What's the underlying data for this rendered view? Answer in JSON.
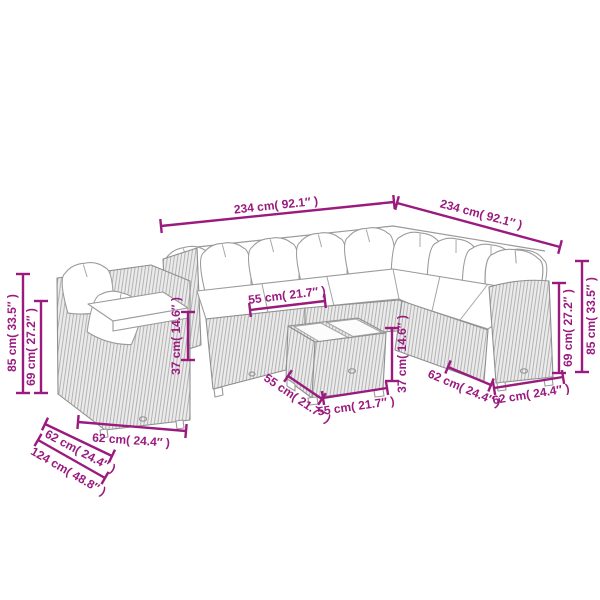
{
  "diagram": {
    "type": "furniture-dimension-diagram",
    "subject": "rattan corner sofa set with coffee table",
    "colors": {
      "dimension_accent": "#9a1a7e",
      "line_art": "#9a9a9a",
      "rattan_fill": "#ebebeb",
      "rattan_hatch": "#b2b2b2",
      "cushion": "#ffffff",
      "background": "#ffffff"
    },
    "dimensions": [
      {
        "id": "sofa-width-left",
        "label": "234 cm( 92.1″ )",
        "cm": 234,
        "inch": 92.1
      },
      {
        "id": "sofa-width-right",
        "label": "234 cm( 92.1″ )",
        "cm": 234,
        "inch": 92.1
      },
      {
        "id": "back-height-left",
        "label": "85 cm( 33.5″ )",
        "cm": 85,
        "inch": 33.5
      },
      {
        "id": "arm-height-left",
        "label": "69 cm( 27.2″ )",
        "cm": 69,
        "inch": 27.2
      },
      {
        "id": "seat-height-left",
        "label": "37 cm( 14.6″ )",
        "cm": 37,
        "inch": 14.6
      },
      {
        "id": "seat-width",
        "label": "55 cm( 21.7″ )",
        "cm": 55,
        "inch": 21.7
      },
      {
        "id": "table-height",
        "label": "37 cm( 14.6″ )",
        "cm": 37,
        "inch": 14.6
      },
      {
        "id": "table-depth",
        "label": "55 cm( 21.7″ )",
        "cm": 55,
        "inch": 21.7
      },
      {
        "id": "table-width",
        "label": "55 cm( 21.7″ )",
        "cm": 55,
        "inch": 21.7
      },
      {
        "id": "module-depth-right",
        "label": "62 cm( 24.4″ )",
        "cm": 62,
        "inch": 24.4
      },
      {
        "id": "module-width-right",
        "label": "62 cm( 24.4″ )",
        "cm": 62,
        "inch": 24.4
      },
      {
        "id": "arm-height-right",
        "label": "69 cm( 27.2″ )",
        "cm": 69,
        "inch": 27.2
      },
      {
        "id": "back-height-right",
        "label": "85 cm( 33.5″ )",
        "cm": 85,
        "inch": 33.5
      },
      {
        "id": "module-width-left",
        "label": "62 cm( 24.4″ )",
        "cm": 62,
        "inch": 24.4
      },
      {
        "id": "module-depth-left",
        "label": "62 cm( 24.4″ )",
        "cm": 62,
        "inch": 24.4
      },
      {
        "id": "corner-depth-left",
        "label": "124 cm( 48.8″ )",
        "cm": 124,
        "inch": 48.8
      }
    ]
  }
}
